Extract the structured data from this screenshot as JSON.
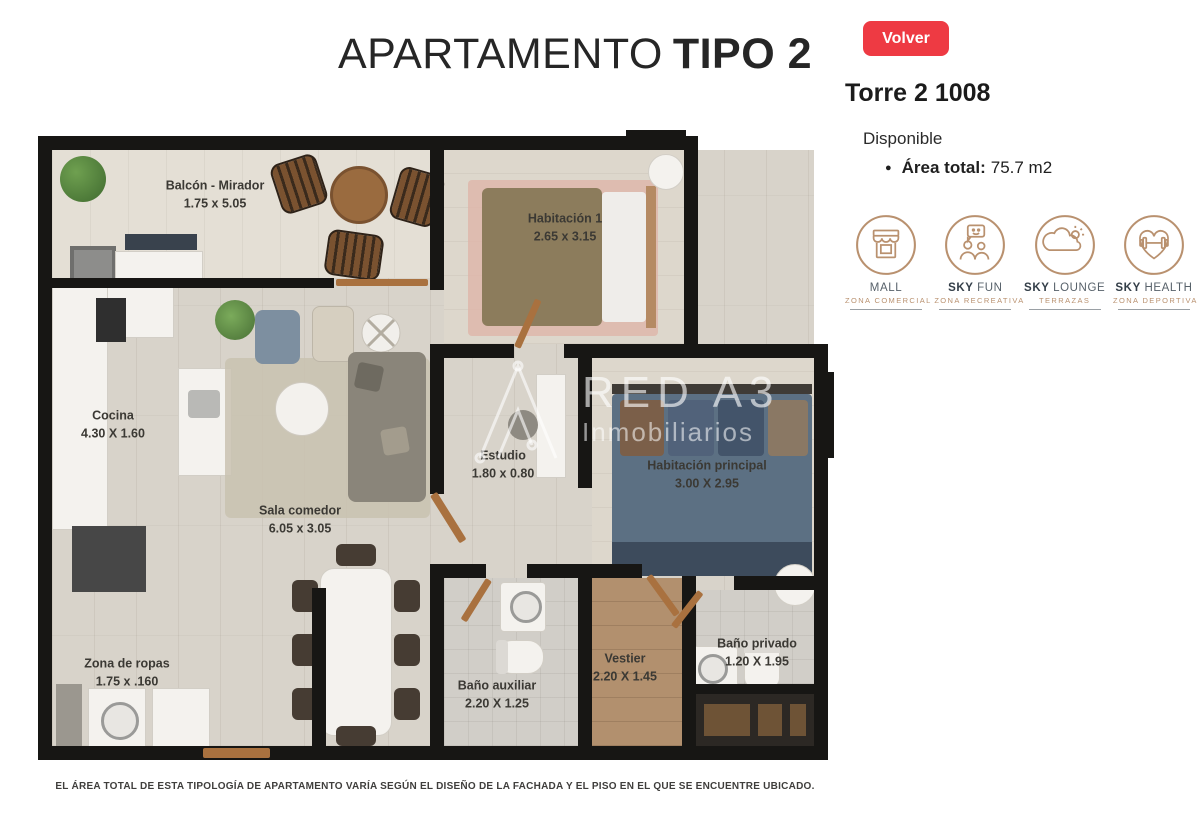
{
  "header": {
    "title_regular": "APARTAMENTO",
    "title_bold": "TIPO 2"
  },
  "panel": {
    "back_button": "Volver",
    "unit_title": "Torre 2 1008",
    "status": "Disponible",
    "area_label": "Área total:",
    "area_value": "75.7 m2",
    "amenities": [
      {
        "title_bold": "",
        "title_rest": "MALL",
        "subtitle": "ZONA COMERCIAL"
      },
      {
        "title_bold": "SKY ",
        "title_rest": "FUN",
        "subtitle": "ZONA RECREATIVA"
      },
      {
        "title_bold": "SKY ",
        "title_rest": "LOUNGE",
        "subtitle": "TERRAZAS"
      },
      {
        "title_bold": "SKY ",
        "title_rest": "HEALTH",
        "subtitle": "ZONA DEPORTIVA"
      }
    ]
  },
  "floorplan": {
    "watermark": {
      "line1": "RED A3",
      "line2": "Inmobiliarios"
    },
    "rooms": [
      {
        "name": "Balcón - Mirador",
        "dims": "1.75 x 5.05"
      },
      {
        "name": "Habitación  1",
        "dims": "2.65 x 3.15"
      },
      {
        "name": "Cocina",
        "dims": "4.30 X 1.60"
      },
      {
        "name": "Sala comedor",
        "dims": "6.05 x 3.05"
      },
      {
        "name": "Estudio",
        "dims": "1.80 x 0.80"
      },
      {
        "name": "Habitación principal",
        "dims": "3.00 X 2.95"
      },
      {
        "name": "Zona de ropas",
        "dims": "1.75 x .160"
      },
      {
        "name": "Baño auxiliar",
        "dims": "2.20 X 1.25"
      },
      {
        "name": "Vestier",
        "dims": "2.20 X 1.45"
      },
      {
        "name": "Baño privado",
        "dims": "1.20 X 1.95"
      }
    ]
  },
  "footer": {
    "disclaimer": "EL ÁREA TOTAL DE ESTA TIPOLOGÍA DE APARTAMENTO VARÍA SEGÚN EL DISEÑO DE LA FACHADA Y EL PISO EN EL QUE SE ENCUENTRE UBICADO."
  },
  "colors": {
    "accent_red": "#ee3a43",
    "icon_tan": "#b9916f"
  }
}
